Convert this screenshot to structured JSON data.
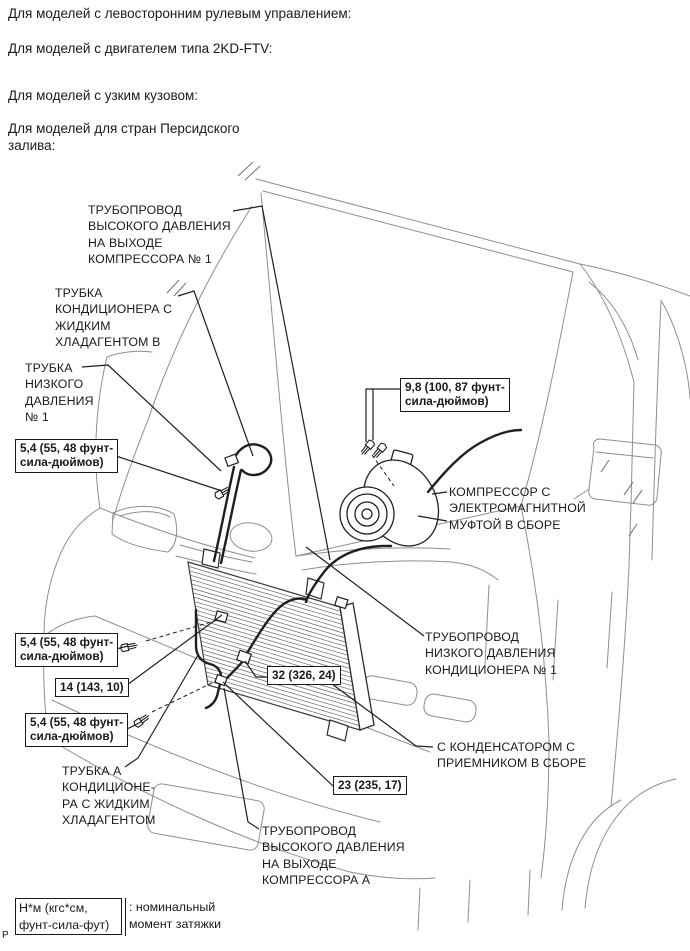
{
  "colors": {
    "background": "#ffffff",
    "text": "#1a1a1a",
    "vehicle_art": "#8e8e8e",
    "dark_parts": "#1f1f1f",
    "hatch": "#666666"
  },
  "headers": {
    "line1": "Для моделей с левосторонним рулевым управлением:",
    "line2": "Для моделей с двигателем типа 2KD-FTV:",
    "line3": "Для моделей с узким кузовом:",
    "line4": "Для моделей для стран Персидского\nзалива:"
  },
  "callouts": {
    "high_pressure_outlet_pipe_1": "ТРУБОПРОВОД\nВЫСОКОГО ДАВЛЕНИЯ\nНА ВЫХОДЕ\nКОМПРЕССОРА № 1",
    "liquid_refrigerant_tube_b": "ТРУБКА\nКОНДИЦИОНЕРА С\nЖИДКИМ\nХЛАДАГЕНТОМ В",
    "low_pressure_tube_1": "ТРУБКА\nНИЗКОГО\nДАВЛЕНИЯ\n№ 1",
    "compressor_assembly": "КОМПРЕССОР С\nЭЛЕКТРОМАГНИТНОЙ\nМУФТОЙ В СБОРЕ",
    "low_pressure_pipe_1": "ТРУБОПРОВОД\nНИЗКОГО ДАВЛЕНИЯ\nКОНДИЦИОНЕРА № 1",
    "condenser_receiver_assembly": "С КОНДЕНСАТОРОМ С\nПРИЕМНИКОМ В СБОРЕ",
    "liquid_refrigerant_tube_a": "ТРУБКА А\nКОНДИЦИОНЕ-\nРА С ЖИДКИМ\nХЛАДАГЕНТОМ",
    "high_pressure_outlet_pipe_a": "ТРУБОПРОВОД\nВЫСОКОГО ДАВЛЕНИЯ\nНА ВЫХОДЕ\nКОМПРЕССОРА А"
  },
  "torque_specs": {
    "spec_54_top": "5,4 (55, 48 фунт-\nсила-дюймов)",
    "spec_98": "9,8 (100, 87 фунт-\nсила-дюймов)",
    "spec_54_mid": "5,4 (55, 48 фунт-\nсила-дюймов)",
    "spec_14": "14 (143, 10)",
    "spec_32": "32 (326, 24)",
    "spec_54_bottom": "5,4 (55, 48 фунт-\nсила-дюймов)",
    "spec_23": "23 (235, 17)"
  },
  "legend": {
    "unit_box": "Н*м (кгс*см,\nфунт-сила-фут)",
    "description": ": номинальный\nмомент затяжки"
  },
  "page_marker": "Р"
}
